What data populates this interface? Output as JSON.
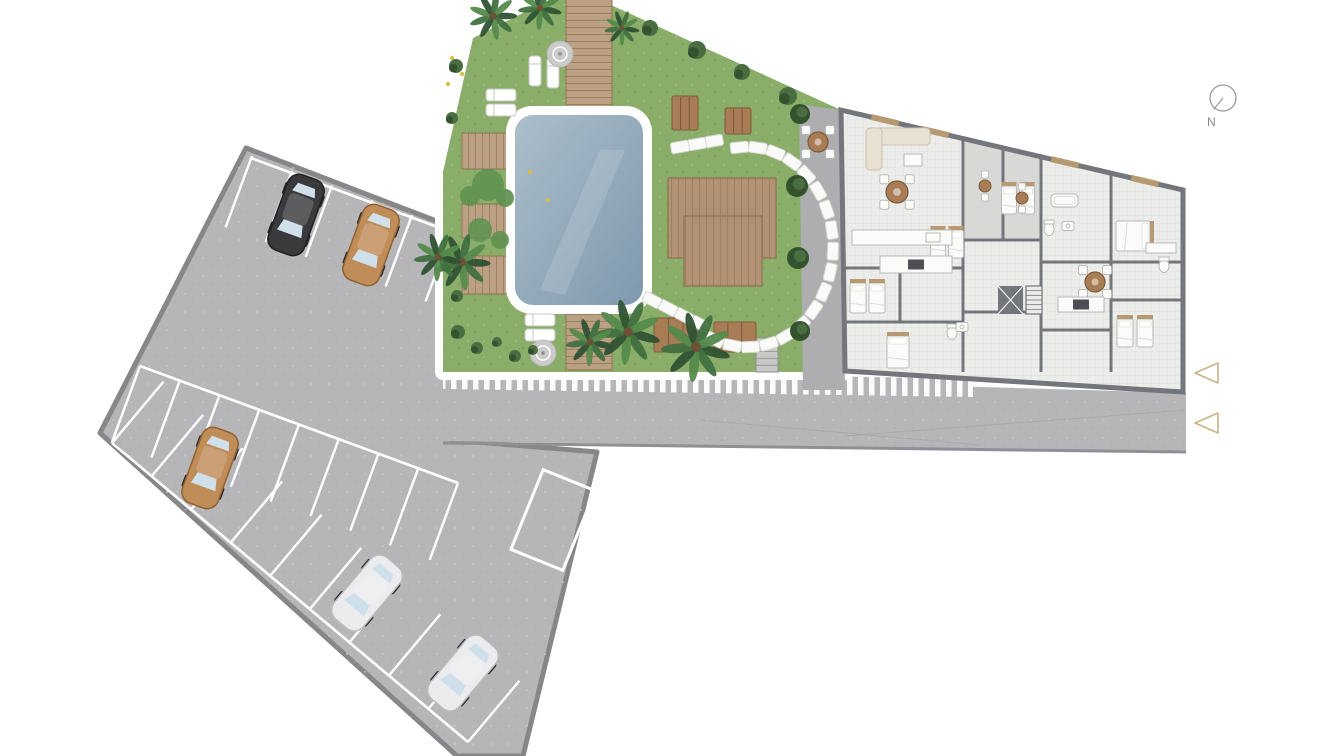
{
  "meta": {
    "title": "Residential complex site plan – ground floor with pool garden and parking"
  },
  "palette": {
    "paving": "#b6b6b8",
    "paving_border": "#87878a",
    "paving_speck": "#c6c6c8",
    "paving_dark": "#a4a4a6",
    "road_edge": "#909094",
    "stall_line": "#ffffff",
    "hatch_bar": "#fbfbfb",
    "grass": "#8aad6a",
    "grass_light": "#a3c283",
    "grass_dark": "#6f9551",
    "pool_rim": "#ffffff",
    "pool_deep": "#7f98ad",
    "pool_light": "#abbecb",
    "deck": "#bba083",
    "deck_line": "#9a7f61",
    "deck_edge": "#8d734f",
    "platform": "#b29274",
    "picnic": "#a87c54",
    "picnic_dark": "#7d5a3a",
    "stone": "#fafaf8",
    "stone_edge": "#d8d8d2",
    "planter_green": "#4c7a40",
    "planter_green2": "#639352",
    "flower": "#c04a3e",
    "flower2": "#d9c04a",
    "bush": "#4a6e42",
    "bush_dark": "#35522f",
    "palm_dark": "#2f5233",
    "palm_mid": "#417040",
    "palm_light": "#558a4c",
    "trunk": "#6b5236",
    "patio": "#aeaeb0",
    "stair": "#c9c9c7",
    "stair_edge": "#8d8d8b",
    "wall": "#73767a",
    "floor": "#ececea",
    "tile": "#dfdfdb",
    "balcony_floor": "#d8d8d6",
    "furn_white": "#fbfbfa",
    "furn_stroke": "#b9b9b5",
    "wood": "#b79a72",
    "sofa": "#e8e0d1",
    "sofa_stroke": "#c9bfae",
    "appliance": "#4d4f52",
    "car_black": "#3a3a3c",
    "car_tan": "#c08c58",
    "car_white": "#ececee",
    "car_window": "#cfe0ea",
    "wheel": "#2b2b2d",
    "lounger": "#ffffff",
    "lounger_stroke": "#c6c6c2",
    "umbrella": "#cbcbcb",
    "umbrella_ring": "#ffffff",
    "compass": "#9b9b9b",
    "label": "#8a8a8a",
    "arrow": "#c9b485"
  },
  "compass": {
    "cx": 1223,
    "cy": 98,
    "r": 13,
    "needle": [
      1213.5,
      109.5
    ],
    "label": "N",
    "label_pos": [
      1207,
      126
    ]
  },
  "arrows": [
    {
      "points": [
        [
          1218,
          363
        ],
        [
          1218,
          383
        ],
        [
          1195,
          373
        ]
      ]
    },
    {
      "points": [
        [
          1218,
          413
        ],
        [
          1218,
          433
        ],
        [
          1195,
          423
        ]
      ]
    }
  ],
  "parking": {
    "outline": [
      [
        246,
        148
      ],
      [
        452,
        227
      ],
      [
        452,
        440
      ],
      [
        597,
        452
      ],
      [
        523,
        756
      ],
      [
        457,
        756
      ],
      [
        100,
        433
      ]
    ],
    "inner_lines": [
      [
        251,
        158,
        451,
        232
      ],
      [
        140,
        366,
        458,
        483
      ],
      [
        112,
        443,
        468,
        742
      ]
    ],
    "stall_rows": [
      {
        "x1": 252,
        "y1": 156,
        "x2": 452,
        "y2": 230,
        "depth": 76,
        "count": 6,
        "side": 1
      },
      {
        "x1": 140,
        "y1": 366,
        "x2": 458,
        "y2": 483,
        "depth": 82,
        "count": 9,
        "side": 1
      },
      {
        "x1": 112,
        "y1": 443,
        "x2": 468,
        "y2": 742,
        "depth": 80,
        "count": 10,
        "side": -1
      }
    ],
    "reserved_box": {
      "cx": 553,
      "cy": 520,
      "w": 56,
      "h": 86,
      "rot": 22
    },
    "cars": [
      {
        "color": "black",
        "x": 296,
        "y": 215,
        "rot": 200
      },
      {
        "color": "tan",
        "x": 371,
        "y": 245,
        "rot": 200
      },
      {
        "color": "tan",
        "x": 210,
        "y": 468,
        "rot": 200
      },
      {
        "color": "white",
        "x": 367,
        "y": 593,
        "rot": 220
      },
      {
        "color": "white",
        "x": 463,
        "y": 673,
        "rot": 220
      }
    ]
  },
  "road": {
    "outline": [
      [
        443,
        371
      ],
      [
        1186,
        393
      ],
      [
        1186,
        453
      ],
      [
        443,
        441
      ]
    ],
    "edge": [
      443,
      443,
      1186,
      452
    ],
    "joints": [
      [
        845,
        436,
        1186,
        410
      ],
      [
        700,
        420,
        980,
        445
      ]
    ]
  },
  "walkway": {
    "outline": [
      [
        443,
        369
      ],
      [
        973,
        379
      ],
      [
        973,
        397
      ],
      [
        443,
        389
      ]
    ]
  },
  "garden": {
    "outline": [
      [
        473,
        38
      ],
      [
        549,
        0
      ],
      [
        600,
        0
      ],
      [
        841,
        110
      ],
      [
        845,
        372
      ],
      [
        443,
        372
      ],
      [
        443,
        172
      ]
    ],
    "decks": [
      {
        "x": 566,
        "y": -4,
        "w": 46,
        "h": 118,
        "dir": "h"
      },
      {
        "x": 566,
        "y": 300,
        "w": 46,
        "h": 70,
        "dir": "h"
      },
      {
        "x": 462,
        "y": 133,
        "w": 94,
        "h": 36,
        "dir": "v"
      },
      {
        "x": 462,
        "y": 204,
        "w": 94,
        "h": 34,
        "dir": "v"
      },
      {
        "x": 462,
        "y": 256,
        "w": 50,
        "h": 38,
        "dir": "v"
      }
    ],
    "planter": {
      "x": 513,
      "y": 169,
      "w": 44,
      "h": 36
    },
    "platforms": [
      {
        "x": 668,
        "y": 178,
        "w": 108,
        "h": 80
      },
      {
        "x": 684,
        "y": 216,
        "w": 78,
        "h": 70
      }
    ],
    "picnic_tables": [
      {
        "x": 672,
        "y": 96,
        "w": 26,
        "h": 34
      },
      {
        "x": 725,
        "y": 108,
        "w": 26,
        "h": 26
      },
      {
        "x": 654,
        "y": 318,
        "w": 44,
        "h": 34
      },
      {
        "x": 714,
        "y": 322,
        "w": 42,
        "h": 30
      }
    ],
    "pool": {
      "x": 506,
      "y": 106,
      "w": 146,
      "h": 208,
      "rim": 9,
      "rx": 26
    },
    "stones_arc": {
      "cx": 747,
      "cy": 247,
      "rx": 86,
      "ry": 100,
      "a1": -95,
      "a2": 112,
      "n": 18
    },
    "stones_tails": [
      {
        "x": 714,
        "y": 141,
        "dx": -17,
        "dy": 3,
        "n": 3,
        "rot": -10
      },
      {
        "x": 700,
        "y": 324,
        "dx": -16,
        "dy": -8,
        "n": 4,
        "rot": 28
      }
    ],
    "stair": {
      "x": 756,
      "y": 338,
      "w": 22,
      "h": 34
    },
    "loungers": [
      {
        "x": 535,
        "y": 71,
        "rot": 90
      },
      {
        "x": 553,
        "y": 73,
        "rot": 90
      },
      {
        "x": 501,
        "y": 95,
        "rot": 0
      },
      {
        "x": 501,
        "y": 110,
        "rot": 0
      },
      {
        "x": 540,
        "y": 320,
        "rot": 0
      },
      {
        "x": 540,
        "y": 335,
        "rot": 0
      }
    ],
    "umbrellas": [
      {
        "x": 560,
        "y": 54
      },
      {
        "x": 543,
        "y": 353
      }
    ],
    "bushes": [
      [
        650,
        28,
        8
      ],
      [
        697,
        50,
        9
      ],
      [
        742,
        72,
        8
      ],
      [
        788,
        96,
        9
      ],
      [
        456,
        66,
        7
      ],
      [
        452,
        118,
        6
      ],
      [
        457,
        296,
        6
      ],
      [
        458,
        332,
        7
      ],
      [
        477,
        348,
        6
      ],
      [
        497,
        342,
        5
      ],
      [
        515,
        356,
        6
      ],
      [
        533,
        350,
        5
      ]
    ],
    "ferns": [
      [
        488,
        185,
        16
      ],
      [
        470,
        196,
        10
      ],
      [
        505,
        198,
        9
      ],
      [
        480,
        230,
        12
      ],
      [
        500,
        240,
        9
      ]
    ],
    "patio_trees": [
      [
        800,
        114,
        10
      ],
      [
        797,
        186,
        11
      ],
      [
        798,
        258,
        11
      ],
      [
        800,
        331,
        10
      ]
    ],
    "palms": [
      [
        493,
        16,
        22
      ],
      [
        540,
        8,
        20
      ],
      [
        462,
        262,
        26
      ],
      [
        628,
        332,
        30
      ],
      [
        696,
        347,
        32
      ],
      [
        590,
        342,
        22
      ],
      [
        438,
        257,
        22
      ],
      [
        622,
        28,
        16
      ]
    ],
    "flowers": [
      [
        452,
        58
      ],
      [
        462,
        74
      ],
      [
        448,
        84
      ],
      [
        530,
        172
      ],
      [
        548,
        200
      ]
    ]
  },
  "patio": {
    "outline": [
      [
        799,
        104
      ],
      [
        841,
        110
      ],
      [
        845,
        390
      ],
      [
        803,
        390
      ]
    ],
    "dining": {
      "x": 818,
      "y": 142,
      "r": 10
    }
  },
  "building": {
    "outline": [
      [
        841,
        110
      ],
      [
        1183,
        190
      ],
      [
        1183,
        392
      ],
      [
        845,
        371
      ]
    ],
    "balcony": [
      [
        965,
        139
      ],
      [
        1041,
        157
      ],
      [
        1041,
        240
      ],
      [
        965,
        240
      ]
    ],
    "walls": [
      [
        963,
        138,
        963,
        372
      ],
      [
        1041,
        156,
        1041,
        372
      ],
      [
        1111,
        172,
        1111,
        372
      ],
      [
        845,
        268,
        963,
        268
      ],
      [
        845,
        322,
        963,
        322
      ],
      [
        963,
        240,
        1041,
        240
      ],
      [
        963,
        312,
        1041,
        312
      ],
      [
        1041,
        262,
        1111,
        262
      ],
      [
        1041,
        330,
        1111,
        330
      ],
      [
        1111,
        262,
        1183,
        262
      ],
      [
        1111,
        300,
        1183,
        300
      ],
      [
        1003,
        146,
        1003,
        240
      ],
      [
        900,
        268,
        900,
        322
      ]
    ],
    "windows": [
      885,
      935,
      1065,
      1145
    ],
    "beds": [
      {
        "x": 858,
        "y": 298,
        "rot": 0,
        "w": 16,
        "h": 30
      },
      {
        "x": 877,
        "y": 298,
        "rot": 0,
        "w": 16,
        "h": 30
      },
      {
        "x": 938,
        "y": 244,
        "rot": 0,
        "w": 15,
        "h": 28
      },
      {
        "x": 956,
        "y": 244,
        "rot": 0,
        "w": 15,
        "h": 28
      },
      {
        "x": 1009,
        "y": 200,
        "rot": 0,
        "w": 15,
        "h": 28
      },
      {
        "x": 1027,
        "y": 200,
        "rot": 0,
        "w": 15,
        "h": 28
      },
      {
        "x": 1133,
        "y": 236,
        "rot": 90,
        "w": 30,
        "h": 34
      },
      {
        "x": 1125,
        "y": 333,
        "rot": 0,
        "w": 16,
        "h": 28
      },
      {
        "x": 1145,
        "y": 333,
        "rot": 0,
        "w": 16,
        "h": 28
      },
      {
        "x": 898,
        "y": 352,
        "rot": 0,
        "w": 22,
        "h": 32
      }
    ],
    "tables": [
      {
        "x": 897,
        "y": 192,
        "r": 11
      },
      {
        "x": 1095,
        "y": 282,
        "r": 10
      }
    ],
    "bistros": [
      [
        985,
        186
      ],
      [
        1022,
        198
      ]
    ],
    "sofa": {
      "x": 866,
      "y": 128
    },
    "counters": [
      {
        "x": 852,
        "y": 230,
        "w": 100,
        "h": 15,
        "cook": false
      },
      {
        "x": 880,
        "y": 256,
        "w": 72,
        "h": 17,
        "cook": true
      },
      {
        "x": 1058,
        "y": 297,
        "w": 46,
        "h": 15,
        "cook": true
      }
    ],
    "tubs": [
      {
        "x": 1051,
        "y": 194,
        "w": 27,
        "h": 13
      }
    ],
    "toilets": [
      [
        1049,
        229
      ],
      [
        952,
        333
      ],
      [
        1164,
        266
      ]
    ],
    "sinks": [
      [
        1068,
        226
      ],
      [
        962,
        327
      ]
    ],
    "vanities": [
      {
        "x": 1146,
        "y": 243,
        "w": 30,
        "h": 10
      }
    ],
    "elevator": {
      "x": 998,
      "y": 286,
      "w": 25,
      "h": 28
    },
    "stairs": {
      "x": 1026,
      "y": 286,
      "w": 16,
      "h": 28
    }
  }
}
